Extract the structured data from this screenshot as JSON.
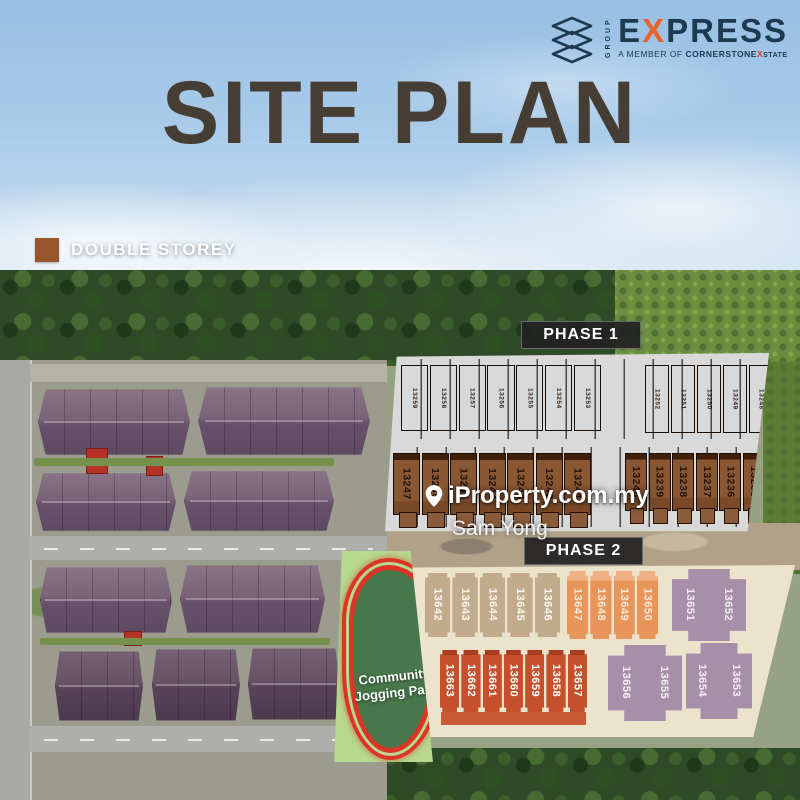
{
  "brand": {
    "group": "GROUP",
    "name_pre": "E",
    "name_x": "X",
    "name_post": "PRESS",
    "member_pre": "A MEMBER OF ",
    "member_co": "CORNERSTONE",
    "member_x": "X",
    "member_post": "STATE"
  },
  "title": "SITE PLAN",
  "legend": {
    "label": "DOUBLE STOREY",
    "color": "#96562e"
  },
  "watermark": {
    "line1": "iProperty.com.my",
    "line2": "Sam Yong"
  },
  "phase1": {
    "label": "PHASE 1",
    "top_left": [
      "13259",
      "13258",
      "13257",
      "13256",
      "13255",
      "13254",
      "13253"
    ],
    "top_right": [
      "13252",
      "13251",
      "13250",
      "13249",
      "13248"
    ],
    "bottom_left": [
      "13247",
      "13246",
      "13245",
      "13244",
      "13243",
      "13242",
      "13241"
    ],
    "bottom_right": [
      "13240",
      "13239",
      "13238",
      "13237",
      "13236",
      "13235"
    ]
  },
  "phase2": {
    "label": "PHASE 2",
    "top_tan": [
      "13642",
      "13643",
      "13644",
      "13645",
      "13646"
    ],
    "top_orange": [
      "13647",
      "13648",
      "13649",
      "13650"
    ],
    "top_purple": [
      "13651",
      "13652"
    ],
    "bottom_red": [
      "13663",
      "13662",
      "13661",
      "13660",
      "13659",
      "13658",
      "13657"
    ],
    "bottom_purple_a": [
      "13656",
      "13655"
    ],
    "bottom_purple_b": [
      "13654",
      "13653"
    ]
  },
  "park": {
    "line1": "Community",
    "line2": "Jogging Park"
  },
  "palette": {
    "brand_navy": "#1d3a50",
    "brand_orange": "#e8622d",
    "title_brown": "#463e35",
    "phase1_dark_brown": "#5f2f12",
    "phase1_mid_brown": "#8a5733",
    "phase2_tan": "#c2ab8c",
    "phase2_orange": "#e8955a",
    "phase2_purple": "#a78fa9",
    "phase2_red": "#c4512c",
    "park_green": "#b7d88f",
    "track_red": "#dc3427"
  }
}
